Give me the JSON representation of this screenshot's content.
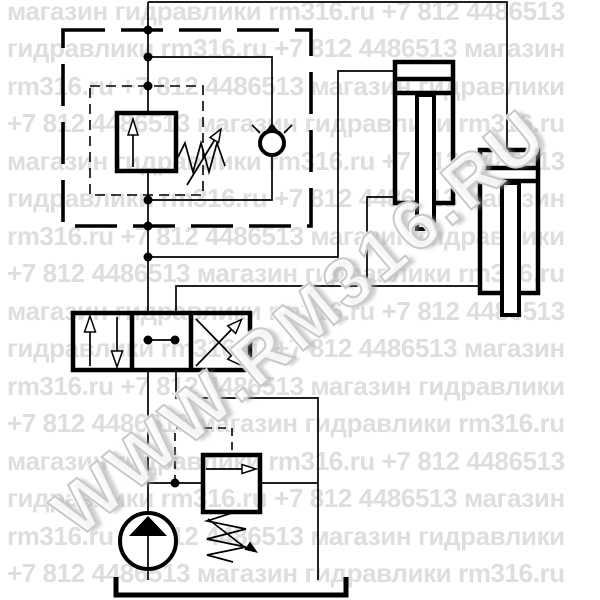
{
  "watermark": {
    "diagonal": "WWW.RM316.RU",
    "rows": [
      "магазин гидравлики rm316.ru +7 812 4486513",
      "гидравлики rm316.ru +7 812 4486513 магазин",
      "rm316.ru +7 812 4486513 магазин гидравлики",
      "+7 812 4486513 магазин гидравлики rm316.ru",
      "магазин гидравлики rm316.ru +7 812 4486513",
      "гидравлики rm316.ru +7 812 4486513 магазин",
      "rm316.ru +7 812 4486513 магазин гидравлики",
      "+7 812 4486513 магазин гидравлики rm316.ru",
      "магазин гидравлики rm316.ru +7 812 4486513",
      "гидравлики rm316.ru +7 812 4486513 магазин",
      "rm316.ru +7 812 4486513 магазин гидравлики",
      "+7 812 4486513 магазин гидравлики rm316.ru",
      "магазин гидравлики rm316.ru +7 812 4486513",
      "гидравлики rm316.ru +7 812 4486513 магазин",
      "rm316.ru +7 812 4486513 магазин гидравлики",
      "+7 812 4486513 магазин гидравлики rm316.ru"
    ]
  },
  "diagram": {
    "symbols": [
      "adjustable-pressure-valve",
      "bypass-check-valve",
      "hydraulic-cylinder",
      "hydraulic-cylinder",
      "4-3-directional-control-valve",
      "adjustable-pressure-relief-valve",
      "hydraulic-pump",
      "tank"
    ],
    "colors": {
      "line": "#000000",
      "watermark": "#dedede",
      "background": "#ffffff"
    }
  }
}
